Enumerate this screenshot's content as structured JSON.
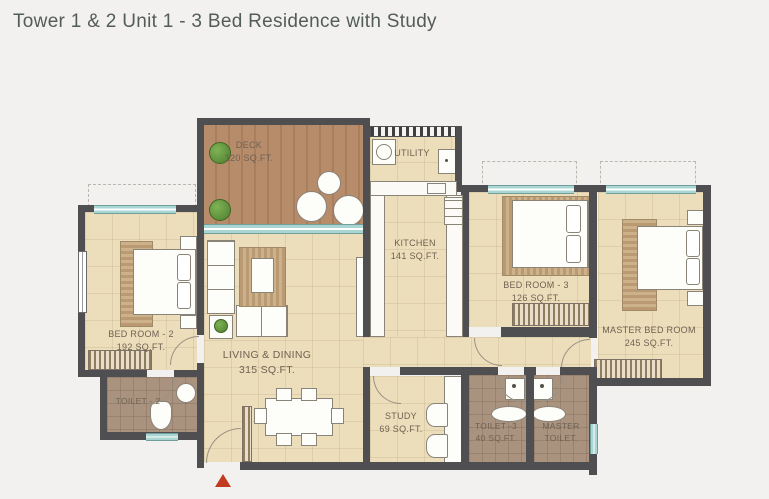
{
  "title": "Tower 1 & 2 Unit 1 - 3 Bed Residence with Study",
  "colors": {
    "wall": "#4f4f51",
    "floor": "#ecdebb",
    "deck": "#b4886a",
    "toilet_floor": "#a9937f",
    "window": "#a9d6d3",
    "arrow": "#c23a20",
    "background": "#f2f1ef",
    "title": "#535c56",
    "label": "#6f6152"
  },
  "rooms": {
    "deck": {
      "name": "DECK",
      "area": "120 SQ.FT."
    },
    "utility": {
      "name": "UTILITY"
    },
    "kitchen": {
      "name": "KITCHEN",
      "area": "141 SQ.FT."
    },
    "bedroom3": {
      "name": "BED ROOM - 3",
      "area": "126 SQ.FT."
    },
    "master_bedroom": {
      "name": "MASTER BED ROOM",
      "area": "245 SQ.FT."
    },
    "bedroom2": {
      "name": "BED ROOM - 2",
      "area": "192 SQ.FT."
    },
    "living_dining": {
      "name": "LIVING & DINING",
      "area": "315 SQ.FT."
    },
    "study": {
      "name": "STUDY",
      "area": "69 SQ.FT."
    },
    "toilet2": {
      "name": "TOILET - 2"
    },
    "toilet3": {
      "name": "TOILET -3",
      "area": "40 SQ.FT."
    },
    "master_toilet": {
      "name": "MASTER TOILET."
    }
  }
}
